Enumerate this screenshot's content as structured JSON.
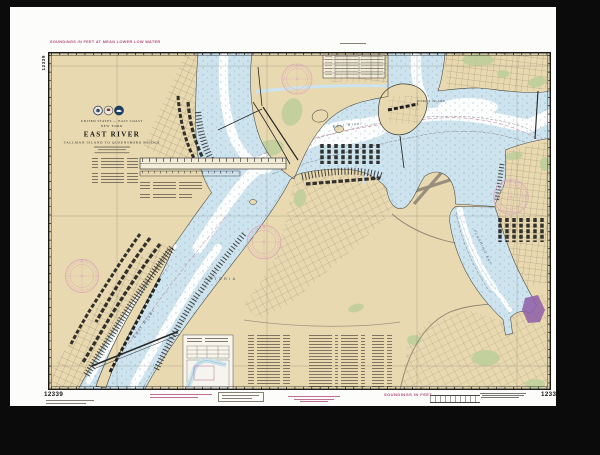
{
  "chart": {
    "number": "12339",
    "top_margin_note": "SOUNDINGS IN FEET AT MEAN LOWER LOW WATER",
    "bottom_margin_note": "SOUNDINGS IN FEET",
    "title_block": {
      "nation": "UNITED STATES — EAST COAST",
      "region": "NEW YORK",
      "title": "EAST RIVER",
      "subtitle": "TALLMAN ISLAND TO QUEENSBORO BRIDGE"
    },
    "place_labels": {
      "river": "East River",
      "rikers_island": "RIKERS ISLAND",
      "astoria": "ASTORIA",
      "flushing_bay": "FLUSHING BAY"
    },
    "colors": {
      "frame": "#0b0b0b",
      "mat": "#fcfcfa",
      "land": "#e8d9b0",
      "water-shallow": "#cde3ee",
      "water-deep": "#fcfdfd",
      "green": "#bfd09c",
      "magenta": "#b04a7d",
      "rose": "#dcaab8",
      "purple": "#8e5da8",
      "ink": "#1c1c1a"
    }
  }
}
